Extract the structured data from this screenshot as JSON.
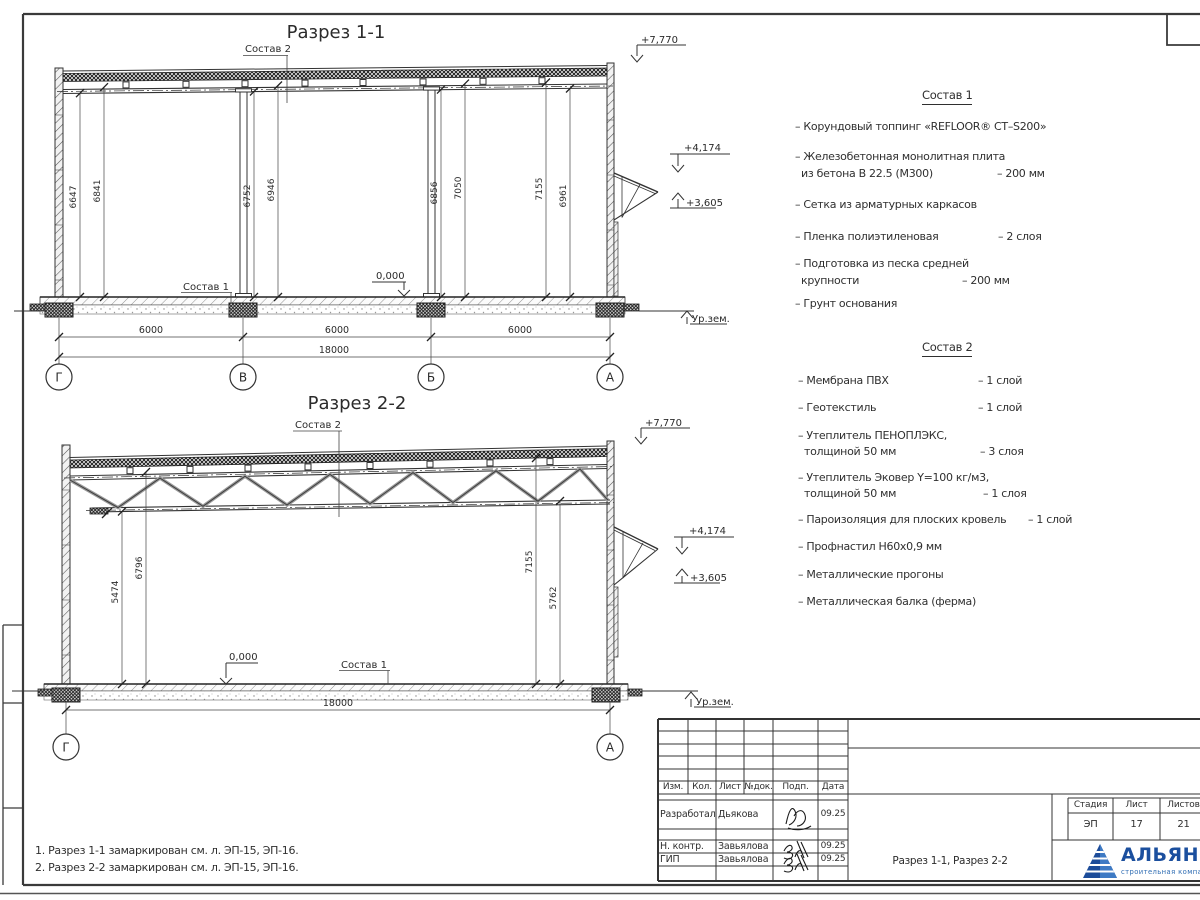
{
  "section1": {
    "title": "Разрез 1-1",
    "label_sostav2": "Состав 2",
    "label_sostav1": "Состав 1",
    "elev_top": "+7,770",
    "elev_canopy_top": "+4,174",
    "elev_canopy_bot": "+3,605",
    "elev_zero": "0,000",
    "ground_label": "Ур.зем.",
    "dims_height": [
      "6647",
      "6841",
      "6752",
      "6946",
      "6856",
      "7050",
      "7155",
      "6961"
    ],
    "dims_span": [
      "6000",
      "6000",
      "6000"
    ],
    "dim_total": "18000",
    "axes": [
      "Г",
      "В",
      "Б",
      "А"
    ]
  },
  "section2": {
    "title": "Разрез 2-2",
    "label_sostav2": "Состав 2",
    "label_sostav1": "Состав 1",
    "elev_top": "+7,770",
    "elev_canopy_top": "+4,174",
    "elev_canopy_bot": "+3,605",
    "elev_zero": "0,000",
    "ground_label": "Ур.зем.",
    "dims_height": [
      "5474",
      "6796",
      "7155",
      "5762"
    ],
    "dim_total": "18000",
    "axes": [
      "Г",
      "А"
    ]
  },
  "sostav1": {
    "title": "Состав 1",
    "items": [
      {
        "l1": "– Корундовый топпинг «REFLOOR® CT–S200»",
        "l2": "",
        "val": ""
      },
      {
        "l1": "– Железобетонная  монолитная плита",
        "l2": "из бетона В 22.5 (М300)",
        "val": "– 200 мм"
      },
      {
        "l1": "– Сетка из арматурных каркасов",
        "l2": "",
        "val": ""
      },
      {
        "l1": "– Пленка полиэтиленовая",
        "l2": "",
        "val": "– 2 слоя"
      },
      {
        "l1": "– Подготовка из песка средней",
        "l2": "крупности",
        "val": "– 200 мм"
      },
      {
        "l1": "– Грунт основания",
        "l2": "",
        "val": ""
      }
    ]
  },
  "sostav2": {
    "title": "Состав 2",
    "items": [
      {
        "l1": "– Мембрана ПВХ",
        "l2": "",
        "val": "– 1 слой"
      },
      {
        "l1": "– Геотекстиль",
        "l2": "",
        "val": "– 1 слой"
      },
      {
        "l1": "– Утеплитель ПЕНОПЛЭКС,",
        "l2": "толщиной 50 мм",
        "val": "– 3 слоя"
      },
      {
        "l1": "– Утеплитель Эковер Y=100 кг/м3,",
        "l2": "толщиной 50 мм",
        "val": "– 1 слоя"
      },
      {
        "l1": "– Пароизоляция для плоских кровель",
        "l2": "",
        "val": "– 1 слой"
      },
      {
        "l1": "– Профнастил Н60х0,9 мм",
        "l2": "",
        "val": ""
      },
      {
        "l1": "– Металлические прогоны",
        "l2": "",
        "val": ""
      },
      {
        "l1": "– Металлическая балка (ферма)",
        "l2": "",
        "val": ""
      }
    ]
  },
  "notes": [
    "1. Разрез 1-1 замаркирован см. л. ЭП-15, ЭП-16.",
    "2. Разрез 2-2 замаркирован см. л. ЭП-15, ЭП-16."
  ],
  "titleblock": {
    "rev_headers": [
      "Изм.",
      "Кол.",
      "Лист",
      "№док.",
      "Подп.",
      "Дата"
    ],
    "staff": [
      {
        "role": "Разработал",
        "name": "Дьякова",
        "date": "09.25"
      },
      {
        "role": "Н. контр.",
        "name": "Завьялова",
        "date": "09.25"
      },
      {
        "role": "ГИП",
        "name": "Завьялова",
        "date": "09.25"
      }
    ],
    "doc_title": "Разрез 1-1, Разрез 2-2",
    "stage_header": "Стадия",
    "sheet_header": "Лист",
    "sheets_header": "Листов",
    "stage": "ЭП",
    "sheet_num": "17",
    "sheets_total": "21",
    "company": "АЛЬЯНС",
    "company_sub": "строительная компания",
    "brand_color": "#1b4f9e",
    "brand_color_light": "#3e7ac4"
  }
}
